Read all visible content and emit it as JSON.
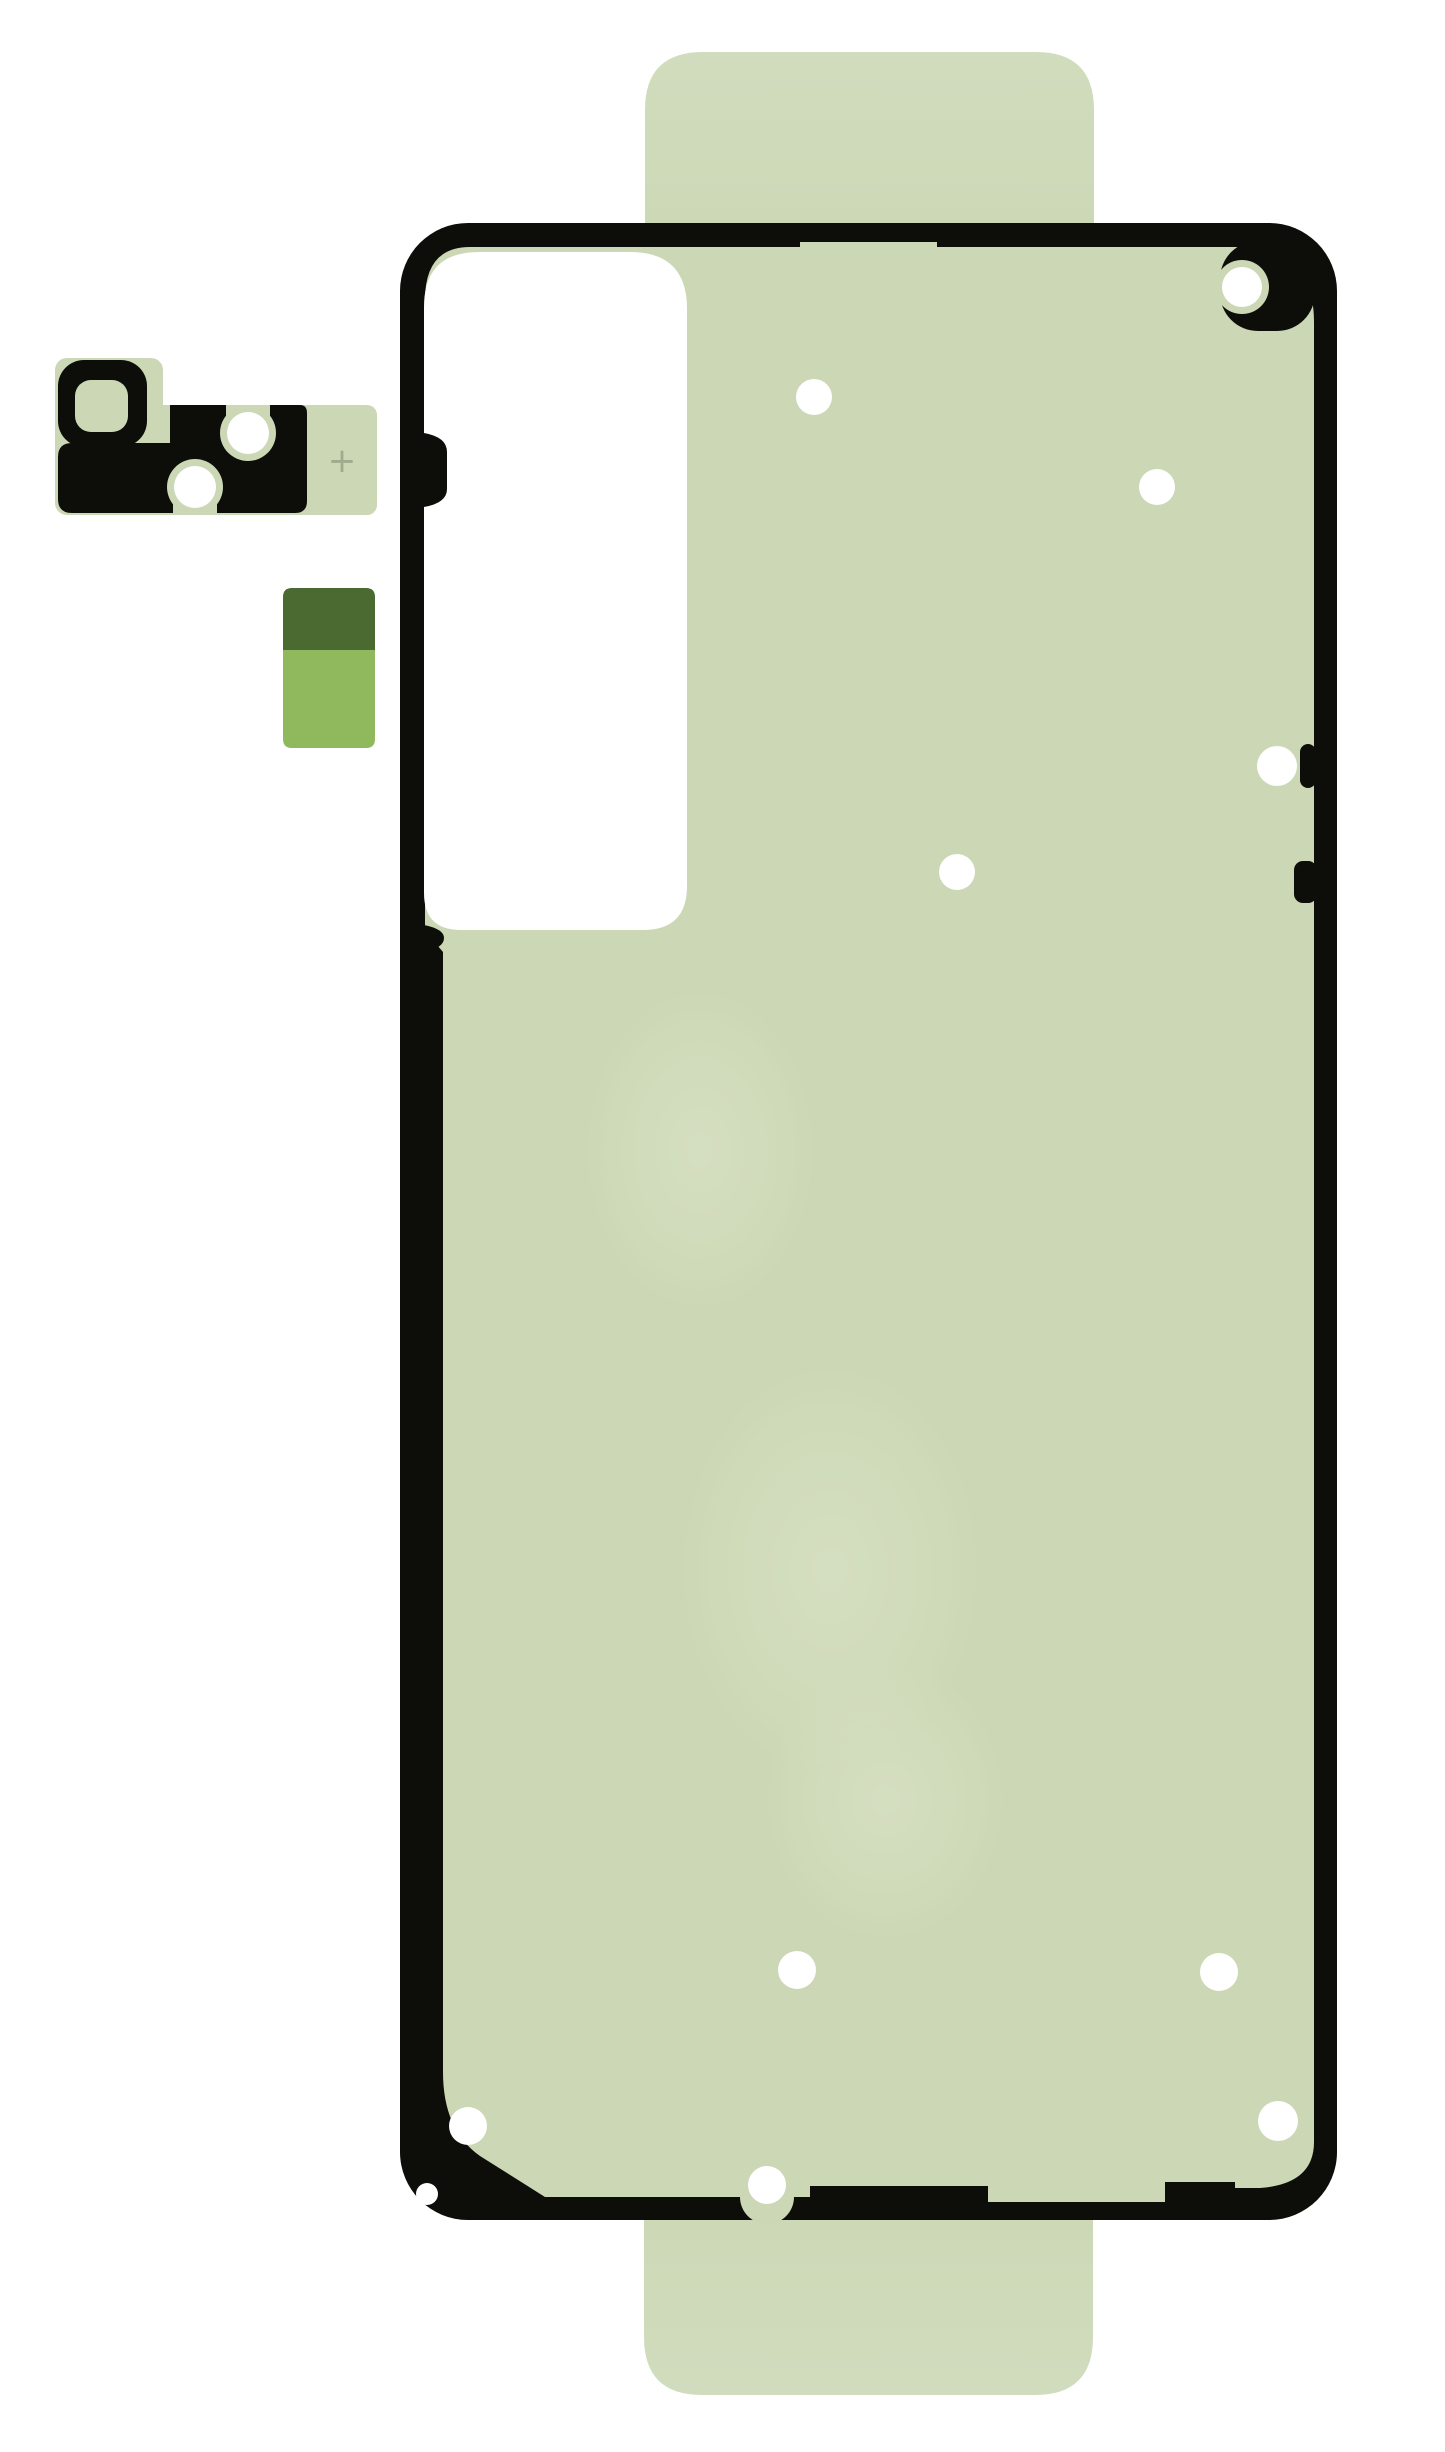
{
  "scene": {
    "description": "Die-cut adhesive sticker sheet for a smartphone back cover, with camera bezel adhesive piece and liner pull sticker",
    "width": 1445,
    "height": 2452
  },
  "colors": {
    "background": "#ffffff",
    "adhesive_green": "#ccd8b5",
    "tab_green": "#d0dcbd",
    "outline_black": "#0d0e0a",
    "blob_green": "#dce5ca",
    "hole_white": "#ffffff",
    "cutout_white": "#ffffff",
    "dark_olive": "#4a6a31",
    "leaf_green": "#8fb95c",
    "mark_gray": "#99a287"
  },
  "sheet": {
    "outline": {
      "x": 400,
      "y": 223,
      "width": 937,
      "height": 1997,
      "corner_radius": 68
    },
    "camera_cutout": {
      "x": 424,
      "y": 252,
      "width": 263,
      "height": 678
    },
    "top_tab": {
      "left": 645,
      "right": 1094,
      "top": 52,
      "corner_radius": 58
    },
    "bottom_tab": {
      "left": 644,
      "right": 1093,
      "bottom": 2395,
      "corner_radius": 58
    },
    "holes": [
      {
        "x": 1242,
        "y": 287,
        "r": 20,
        "ring": true
      },
      {
        "x": 814,
        "y": 397,
        "r": 18
      },
      {
        "x": 1157,
        "y": 487,
        "r": 18
      },
      {
        "x": 1277,
        "y": 766,
        "r": 20
      },
      {
        "x": 957,
        "y": 872,
        "r": 18
      },
      {
        "x": 797,
        "y": 1970,
        "r": 19
      },
      {
        "x": 1219,
        "y": 1972,
        "r": 19
      },
      {
        "x": 468,
        "y": 2126,
        "r": 19
      },
      {
        "x": 1278,
        "y": 2121,
        "r": 20
      },
      {
        "x": 767,
        "y": 2185,
        "r": 19
      }
    ],
    "texture_blobs": [
      {
        "cx": 830,
        "cy": 1570,
        "rx": 150,
        "ry": 205
      },
      {
        "cx": 885,
        "cy": 1800,
        "rx": 120,
        "ry": 140
      },
      {
        "cx": 700,
        "cy": 1150,
        "rx": 115,
        "ry": 160
      }
    ]
  },
  "camera_piece": {
    "registration_mark": "+",
    "mark_x": 342,
    "mark_y": 472,
    "holes": [
      {
        "x": 248,
        "y": 433,
        "r": 21
      },
      {
        "x": 195,
        "y": 487,
        "r": 21
      }
    ]
  },
  "liner_sticker": {
    "x": 283,
    "y": 588,
    "width": 92,
    "height": 160,
    "split_y": 650
  }
}
